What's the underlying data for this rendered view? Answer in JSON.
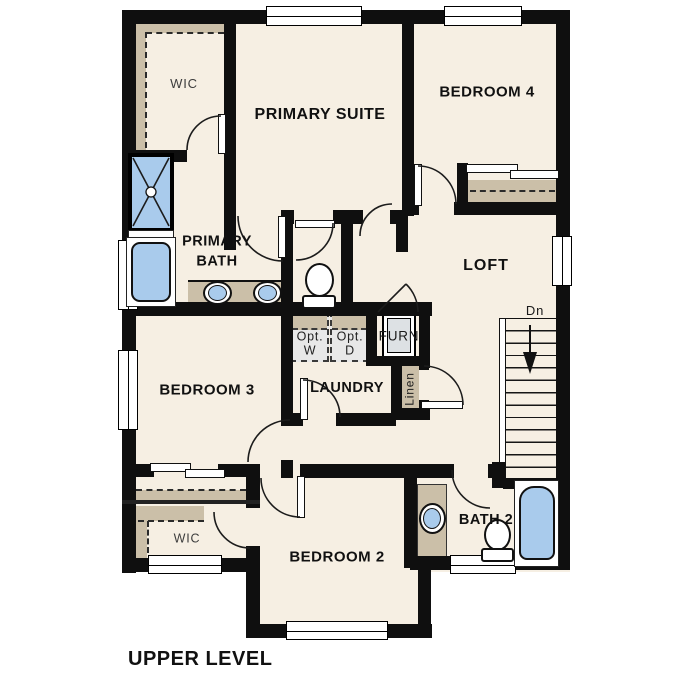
{
  "title": "UPPER LEVEL",
  "labels": {
    "wic_top": "WIC",
    "primary_suite": "PRIMARY SUITE",
    "bedroom_4": "BEDROOM 4",
    "primary_bath": "PRIMARY BATH",
    "loft": "LOFT",
    "bedroom_3": "BEDROOM 3",
    "laundry": "LAUNDRY",
    "opt_washer": "Opt. W",
    "opt_dryer": "Opt. D",
    "furnace": "FURN",
    "linen": "Linen",
    "stairs_down": "Dn",
    "bedroom_2": "BEDROOM 2",
    "bath_2": "BATH 2",
    "wic_bottom": "WIC"
  },
  "colors": {
    "floor": "#f6efe3",
    "wall": "#0f0f0f",
    "casework": "#cbbfa8",
    "fixture": "#a9cbec",
    "appliance": "#e8e8e8",
    "furnace_unit": "#dde1e4"
  }
}
